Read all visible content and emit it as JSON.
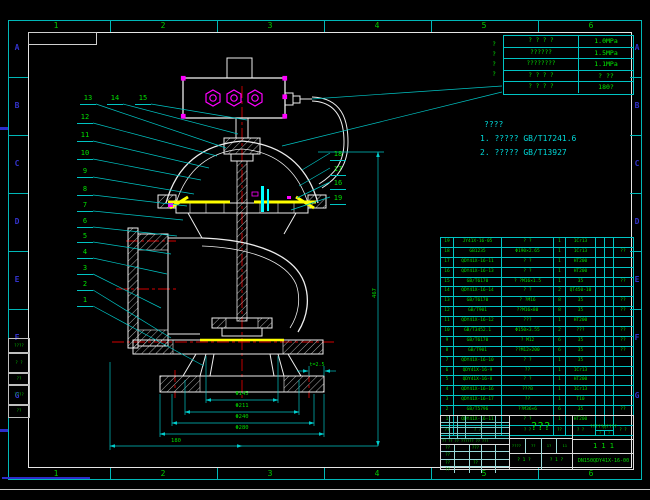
{
  "colors": {
    "green": "#00dd00",
    "cyan": "#00cccc",
    "red": "#dd0000",
    "yellow": "#ffff00",
    "magenta": "#ff00ff",
    "white": "#e6e6e6",
    "blue": "#2d2dcc"
  },
  "zones": {
    "columns": [
      "1",
      "2",
      "3",
      "4",
      "5",
      "6"
    ],
    "rows": [
      "A",
      "B",
      "C",
      "D",
      "E",
      "F",
      "G"
    ]
  },
  "margin_blocks": [
    "????",
    "? ?",
    "??",
    "????",
    "??"
  ],
  "spec_table": {
    "side_label": "????",
    "rows": [
      {
        "label": "? ? ? ?",
        "value": "1.0MPa"
      },
      {
        "label": "??????",
        "value": "1.5MPa"
      },
      {
        "label": "????????",
        "value": "1.1MPa"
      },
      {
        "label": "? ? ? ?",
        "value": "?  ??"
      },
      {
        "label": "? ? ? ?",
        "value": "180?"
      }
    ]
  },
  "notes": {
    "heading": "????",
    "items": [
      {
        "no": "1.",
        "text": "?????",
        "std": "GB/T17241.6"
      },
      {
        "no": "2.",
        "text": "?????",
        "std": "GB/T13927"
      }
    ]
  },
  "callouts": {
    "left_top": [
      "13",
      "14",
      "15"
    ],
    "left": [
      "12",
      "11",
      "10",
      "9",
      "8",
      "7",
      "6",
      "5",
      "4",
      "3",
      "2",
      "1"
    ],
    "right": [
      "18",
      "17",
      "16",
      "19"
    ]
  },
  "dimensions": {
    "d1": "Φ145",
    "d2": "Φ211",
    "d3": "Φ240",
    "d4": "Φ280",
    "width": "180",
    "height": "467",
    "note": "t=2.5"
  },
  "bom": {
    "header": {
      "no": "??",
      "code": "? ?",
      "name": "? ?",
      "qty": "??",
      "material": "? ?",
      "weight": "??",
      "weight_sub": [
        "?",
        "?"
      ],
      "remark": "? ?"
    },
    "rows": [
      {
        "no": "19",
        "code": "JY41X-16-05",
        "name": "? ?",
        "qty": "1",
        "mat": "1Cr13",
        "rem": ""
      },
      {
        "no": "18",
        "code": "GB1235",
        "name": "Φ190×2.65",
        "qty": "1",
        "mat": "1Cr13",
        "rem": "??"
      },
      {
        "no": "17",
        "code": "QDY41X-16-11",
        "name": "? ?",
        "qty": "1",
        "mat": "HT200",
        "rem": ""
      },
      {
        "no": "16",
        "code": "QDY41X-16-13",
        "name": "? ?",
        "qty": "1",
        "mat": "HT200",
        "rem": ""
      },
      {
        "no": "15",
        "code": "GB/T6170",
        "name": "? ?M16×1.5",
        "qty": "1",
        "mat": "35",
        "rem": "??"
      },
      {
        "no": "14",
        "code": "QDY41X-16-14",
        "name": "? ?",
        "qty": "2",
        "mat": "QT450-10",
        "rem": ""
      },
      {
        "no": "13",
        "code": "GB/T6170",
        "name": "? ?M16",
        "qty": "8",
        "mat": "35",
        "rem": "??"
      },
      {
        "no": "12",
        "code": "GB/T901",
        "name": "??M16×80",
        "qty": "8",
        "mat": "35",
        "rem": "??"
      },
      {
        "no": "11",
        "code": "QDY41X-16-12",
        "name": "???",
        "qty": "1",
        "mat": "HT200",
        "rem": ""
      },
      {
        "no": "10",
        "code": "GB/T3452.1",
        "name": "Φ150×3.55",
        "qty": "2",
        "mat": "???",
        "rem": "??"
      },
      {
        "no": "9",
        "code": "GB/T6170",
        "name": "? M12",
        "qty": "6",
        "mat": "35",
        "rem": "??"
      },
      {
        "no": "8",
        "code": "GB/T901",
        "name": "??M12×200",
        "qty": "6",
        "mat": "35",
        "rem": "??"
      },
      {
        "no": "7",
        "code": "QDY41X-16-10",
        "name": "? ?",
        "qty": "1",
        "mat": "35",
        "rem": ""
      },
      {
        "no": "6",
        "code": "QDY41X-16-9",
        "name": "??",
        "qty": "1",
        "mat": "1Cr13",
        "rem": ""
      },
      {
        "no": "5",
        "code": "QDY41X-16-8",
        "name": "? ?",
        "qty": "1",
        "mat": "HT200",
        "rem": ""
      },
      {
        "no": "4",
        "code": "QDY41X-16-16",
        "name": "???B",
        "qty": "1",
        "mat": "1Cr13",
        "rem": ""
      },
      {
        "no": "3",
        "code": "QDY41X-16-17",
        "name": "??",
        "qty": "1",
        "mat": "T10",
        "rem": ""
      },
      {
        "no": "2",
        "code": "GB/T5796",
        "name": "??M36×6",
        "qty": "6",
        "mat": "35",
        "rem": "??"
      },
      {
        "no": "1",
        "code": "QDY41X-16-11",
        "name": "? ?",
        "qty": "1",
        "mat": "HT200",
        "rem": ""
      }
    ]
  },
  "title_block": {
    "title": "???",
    "company": "??????????",
    "stage_marks": "1 1 1",
    "drawing_no": "DN150QDY41X-16-00",
    "rev_line": "?? ?? ?? ?????? ?? ???",
    "sig_col1": [
      "??",
      "??",
      "??",
      "??"
    ],
    "sig_col2": [
      "???",
      "",
      "??",
      ""
    ],
    "sub_cells": [
      "????",
      "??",
      "1?",
      "11"
    ],
    "sheet_cells": [
      "? 1 ?",
      "? 1 ?"
    ]
  }
}
